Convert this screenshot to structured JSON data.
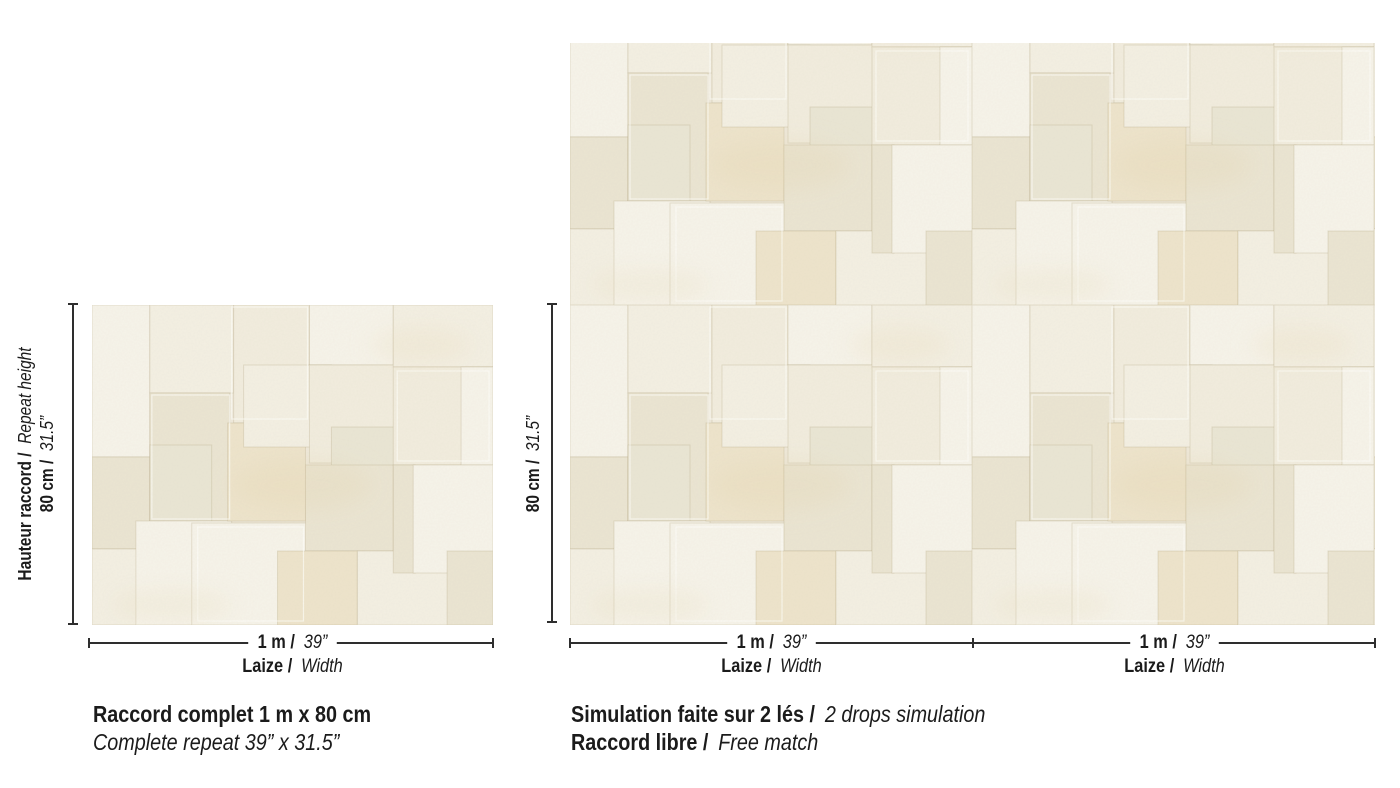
{
  "colors": {
    "background": "#ffffff",
    "ink": "#1b1b1b",
    "dim_line": "#2e2e2e",
    "swatch_base": "#efe9da",
    "swatch_tones": {
      "t0": "#f7f4ea",
      "t1": "#f2edde",
      "t2": "#ebe5d2",
      "t3": "#eee4cb",
      "t4": "#eae6d4",
      "t5": "#f4f0e3"
    },
    "seam": "rgba(167,150,112,0.25)",
    "seam_highlight": "rgba(255,255,250,0.65)"
  },
  "left_figure": {
    "height_label": {
      "name_bold": "Hauteur raccord /",
      "name_italic": "Repeat height",
      "value_bold": "80 cm /",
      "value_italic": "31.5”"
    },
    "width_label": {
      "value_bold": "1 m /",
      "value_italic": "39”",
      "name_bold": "Laize /",
      "name_italic": "Width"
    },
    "caption_line1": "Raccord complet 1 m x 80 cm",
    "caption_line2": "Complete repeat 39” x 31.5”"
  },
  "right_figure": {
    "height_label": {
      "value_bold": "80 cm /",
      "value_italic": "31.5”"
    },
    "drops": [
      {
        "value_bold": "1 m /",
        "value_italic": "39”",
        "name_bold": "Laize /",
        "name_italic": "Width"
      },
      {
        "value_bold": "1 m /",
        "value_italic": "39”",
        "name_bold": "Laize /",
        "name_italic": "Width"
      }
    ],
    "caption_line1_bold": "Simulation faite sur 2 lés /",
    "caption_line1_italic": "2 drops simulation",
    "caption_line2_bold": "Raccord libre /",
    "caption_line2_italic": "Free match"
  }
}
